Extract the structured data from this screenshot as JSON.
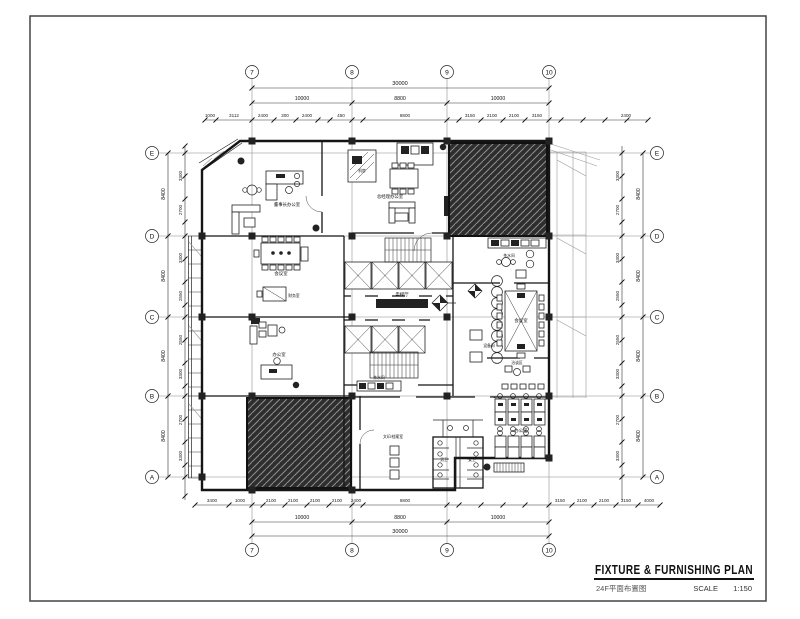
{
  "title_block": {
    "title": "FIXTURE & FURNISHING PLAN",
    "subtitle": "24F平面布置图",
    "scale_label": "SCALE",
    "scale_value": "1:150"
  },
  "grid": {
    "cols": [
      "7",
      "8",
      "9",
      "10"
    ],
    "rows": [
      "E",
      "D",
      "C",
      "B",
      "A"
    ]
  },
  "dims": {
    "top": {
      "overall": "30000",
      "spans": [
        "10000",
        "8800",
        "10000"
      ],
      "chain": [
        "1000",
        "3112",
        "2400",
        "300",
        "2400",
        "450",
        "8800",
        "3150",
        "2100",
        "2100",
        "3150",
        "2400"
      ]
    },
    "bottom": {
      "overall": "30000",
      "spans": [
        "10000",
        "8800",
        "10000"
      ],
      "chain": [
        "3400",
        "1000",
        "2100",
        "2100",
        "2100",
        "2100",
        "2400",
        "8800",
        "3150",
        "2100",
        "2100",
        "3150",
        "4000"
      ]
    },
    "left": {
      "spans": [
        "8400",
        "8400",
        "8400",
        "8400"
      ],
      "chain": [
        "3300",
        "2700",
        "3300",
        "2550",
        "2550",
        "3300",
        "2700",
        "3300"
      ]
    },
    "right": {
      "spans": [
        "8400",
        "8400",
        "8400",
        "8400"
      ],
      "chain": [
        "3300",
        "2700",
        "3300",
        "2550",
        "2550",
        "3300",
        "2700",
        "3300"
      ]
    }
  },
  "rooms": {
    "chairman_office": "董事长办公室",
    "machine_room": "机房",
    "gm_office": "总经理办公室",
    "meeting_room_left": "会议室",
    "finance_room": "财务室",
    "office": "办公室",
    "elevator_lobby": "电梯厅",
    "pantry": "茶水间",
    "meeting_room_right": "会议室",
    "lounge": "洽谈区",
    "open_office": "办公区",
    "copy_room": "文印/档案室",
    "wc_left": "男卫",
    "wc_right": "女卫",
    "pantry_small": "茶水间",
    "equipment_room": "设备间"
  },
  "colors": {
    "wall": "#151515",
    "grid_line": "#888888",
    "hatch_bg": "#2e2e2e",
    "hatch_line": "#8f8f8f"
  }
}
